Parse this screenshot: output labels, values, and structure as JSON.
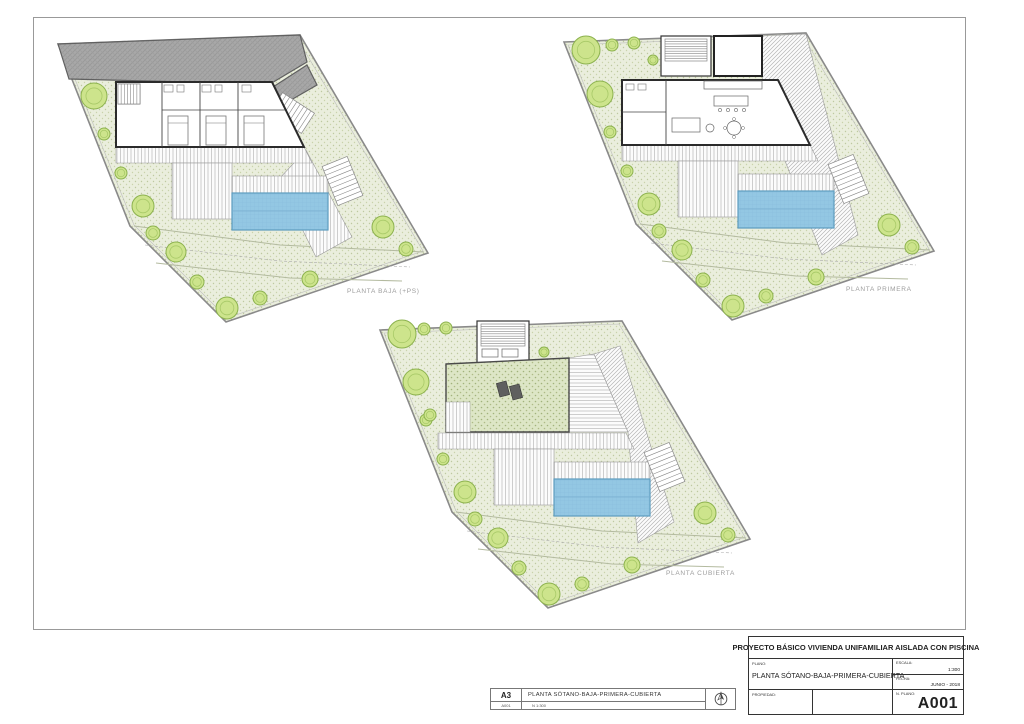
{
  "title_strip": {
    "sheet_size": "A3",
    "sheet_number": "A001",
    "title": "PLANTA SÓTANO-BAJA-PRIMERA-CUBIERTA",
    "scale_note": "N  1:300"
  },
  "title_block": {
    "project_title": "PROYECTO BÁSICO VIVIENDA UNIFAMILIAR AISLADA CON PISCINA",
    "plano_label": "PLANO:",
    "plano_value": "PLANTA SÓTANO-BAJA-PRIMERA-CUBIERTA",
    "escala_label": "ESCALA:",
    "escala_value": "1:300",
    "fecha_label": "FECHA:",
    "fecha_value": "JUNIO - 2018",
    "propiedad_label": "PROPIEDAD:",
    "nplano_label": "N. PLANO:",
    "nplano_value": "A001"
  },
  "colors": {
    "pool": "#93c7e3",
    "garden": "#eaeedd",
    "tree": "#cde48c",
    "street": "#a8a8a8",
    "label_gray": "#9c9c9c"
  },
  "geometry": {
    "base": [
      {
        "k": "poly",
        "pts": [
          [
            8,
            14
          ],
          [
            250,
            5
          ],
          [
            378,
            223
          ],
          [
            176,
            292
          ],
          [
            80,
            196
          ]
        ],
        "f": "pat:garden",
        "st": "#8a8a8a",
        "sw": 1.6
      },
      {
        "k": "poly",
        "pts": [
          [
            12,
            17
          ],
          [
            247,
            8
          ],
          [
            373,
            221
          ],
          [
            177,
            288
          ],
          [
            84,
            195
          ]
        ],
        "f": "none",
        "st": "#bcbcbc",
        "sw": 0.6
      },
      {
        "k": "pline",
        "pts": [
          [
            84,
            196
          ],
          [
            230,
            215
          ],
          [
            374,
            222
          ]
        ],
        "st": "#b3ba9f",
        "sw": 1
      },
      {
        "k": "pline",
        "pts": [
          [
            106,
            233
          ],
          [
            240,
            248
          ],
          [
            352,
            251
          ]
        ],
        "st": "#b3ba9f",
        "sw": 1
      },
      {
        "k": "pline",
        "pts": [
          [
            95,
            215
          ],
          [
            230,
            231
          ],
          [
            360,
            237
          ]
        ],
        "st": "#ababab",
        "sw": 0.6,
        "dash": true
      }
    ],
    "deck_common": [
      {
        "k": "poly",
        "pts": [
          [
            66,
            117
          ],
          [
            254,
            117
          ],
          [
            262,
            133
          ],
          [
            66,
            133
          ]
        ],
        "f": "pat:deckV",
        "st": "#9a9a9a",
        "sw": 0.6
      },
      {
        "k": "rect",
        "x": 122,
        "y": 133,
        "wd": 60,
        "ht": 56,
        "f": "pat:deckV",
        "st": "#9a9a9a",
        "sw": 0.6
      },
      {
        "k": "rect",
        "x": 182,
        "y": 146,
        "wd": 96,
        "ht": 17,
        "f": "pat:deckV",
        "st": "#9a9a9a",
        "sw": 0.6
      },
      {
        "k": "stairs",
        "x": 279,
        "y": 130,
        "wd": 27,
        "ht": 42,
        "n": 9,
        "rot": -22
      }
    ],
    "pool": [
      {
        "k": "rect",
        "x": 182,
        "y": 163,
        "wd": 96,
        "ht": 37,
        "f": "pat:pool",
        "st": "#5d9cbf",
        "sw": 1.2
      },
      {
        "k": "line",
        "x1": 182,
        "y1": 181,
        "x2": 278,
        "y2": 181,
        "st": "#7ab1d1",
        "sw": 0.8
      }
    ],
    "lower_trees": [
      [
        44,
        66,
        13
      ],
      [
        54,
        104,
        6
      ],
      [
        71,
        143,
        6
      ],
      [
        93,
        176,
        11
      ],
      [
        103,
        203,
        7
      ],
      [
        126,
        222,
        10
      ],
      [
        147,
        252,
        7
      ],
      [
        177,
        278,
        11
      ],
      [
        210,
        268,
        7
      ],
      [
        260,
        249,
        8
      ],
      [
        333,
        197,
        11
      ],
      [
        356,
        219,
        7
      ]
    ]
  },
  "plans": [
    {
      "id": "planta-baja",
      "label": "PLANTA BAJA (+PS)",
      "x": 50,
      "y": 30,
      "label_pos": [
        297,
        258
      ],
      "under": [
        {
          "k": "poly",
          "pts": [
            [
              8,
              14
            ],
            [
              250,
              5
            ],
            [
              257,
              32
            ],
            [
              220,
              54
            ],
            [
              19,
              49
            ]
          ],
          "f": "pat:street",
          "st": "#606060",
          "sw": 1.2
        },
        {
          "k": "poly",
          "pts": [
            [
              223,
              57
            ],
            [
              257,
              35
            ],
            [
              267,
              55
            ],
            [
              234,
              74
            ]
          ],
          "f": "pat:street",
          "st": "#606060",
          "sw": 1.2
        },
        {
          "k": "stairs",
          "x": 230,
          "y": 64,
          "wd": 24,
          "ht": 38,
          "n": 9,
          "rot": -57
        },
        {
          "k": "poly",
          "pts": [
            [
              256,
              120
            ],
            [
              302,
              207
            ],
            [
              266,
              227
            ],
            [
              228,
              150
            ]
          ],
          "f": "pat:deckV",
          "st": "#9a9a9a",
          "sw": 0.6
        }
      ],
      "over": [
        {
          "k": "poly",
          "pts": [
            [
              66,
              52
            ],
            [
              222,
              52
            ],
            [
              254,
              117
            ],
            [
              66,
              117
            ]
          ],
          "f": "#ffffff",
          "st": "#2b2b2b",
          "sw": 2
        },
        {
          "k": "line",
          "x1": 112,
          "y1": 52,
          "x2": 112,
          "y2": 117,
          "st": "#444444",
          "sw": 0.9
        },
        {
          "k": "line",
          "x1": 150,
          "y1": 52,
          "x2": 150,
          "y2": 117,
          "st": "#444444",
          "sw": 0.9
        },
        {
          "k": "line",
          "x1": 188,
          "y1": 52,
          "x2": 188,
          "y2": 117,
          "st": "#444444",
          "sw": 0.9
        },
        {
          "k": "line",
          "x1": 112,
          "y1": 80,
          "x2": 235,
          "y2": 80,
          "st": "#444444",
          "sw": 0.7
        },
        {
          "k": "rect",
          "x": 68,
          "y": 54,
          "wd": 22,
          "ht": 20,
          "f": "#ffffff",
          "st": "#555555",
          "sw": 0.8
        },
        {
          "k": "stairs",
          "x": 68,
          "y": 54,
          "wd": 22,
          "ht": 20,
          "n": 7,
          "rot": 0,
          "dir": "v"
        },
        {
          "k": "rect",
          "x": 118,
          "y": 86,
          "wd": 20,
          "ht": 29,
          "f": "#ffffff",
          "st": "#777777",
          "sw": 0.8
        },
        {
          "k": "line",
          "x1": 118,
          "y1": 93,
          "x2": 138,
          "y2": 93,
          "st": "#777777",
          "sw": 0.6
        },
        {
          "k": "rect",
          "x": 156,
          "y": 86,
          "wd": 20,
          "ht": 29,
          "f": "#ffffff",
          "st": "#777777",
          "sw": 0.8
        },
        {
          "k": "line",
          "x1": 156,
          "y1": 93,
          "x2": 176,
          "y2": 93,
          "st": "#777777",
          "sw": 0.6
        },
        {
          "k": "rect",
          "x": 194,
          "y": 86,
          "wd": 20,
          "ht": 29,
          "f": "#ffffff",
          "st": "#777777",
          "sw": 0.8
        },
        {
          "k": "line",
          "x1": 194,
          "y1": 93,
          "x2": 214,
          "y2": 93,
          "st": "#777777",
          "sw": 0.6
        },
        {
          "k": "rect",
          "x": 114,
          "y": 55,
          "wd": 9,
          "ht": 7,
          "f": "none",
          "st": "#777777",
          "sw": 0.6
        },
        {
          "k": "rect",
          "x": 127,
          "y": 55,
          "wd": 7,
          "ht": 7,
          "f": "none",
          "st": "#777777",
          "sw": 0.6
        },
        {
          "k": "rect",
          "x": 152,
          "y": 55,
          "wd": 9,
          "ht": 7,
          "f": "none",
          "st": "#777777",
          "sw": 0.6
        },
        {
          "k": "rect",
          "x": 165,
          "y": 55,
          "wd": 7,
          "ht": 7,
          "f": "none",
          "st": "#777777",
          "sw": 0.6
        },
        {
          "k": "rect",
          "x": 192,
          "y": 55,
          "wd": 9,
          "ht": 7,
          "f": "none",
          "st": "#777777",
          "sw": 0.6
        }
      ],
      "extra_trees": []
    },
    {
      "id": "planta-primera",
      "label": "PLANTA PRIMERA",
      "x": 556,
      "y": 28,
      "label_pos": [
        290,
        258
      ],
      "under": [
        {
          "k": "poly",
          "pts": [
            [
              206,
              8
            ],
            [
              250,
              6
            ],
            [
              302,
              207
            ],
            [
              266,
              227
            ],
            [
              224,
              120
            ],
            [
              206,
              48
            ]
          ],
          "f": "pat:deckD",
          "st": "#9a9a9a",
          "sw": 0.6
        }
      ],
      "over": [
        {
          "k": "rect",
          "x": 105,
          "y": 8,
          "wd": 50,
          "ht": 40,
          "f": "#ffffff",
          "st": "#333333",
          "sw": 1.2
        },
        {
          "k": "stairs",
          "x": 109,
          "y": 11,
          "wd": 42,
          "ht": 22,
          "n": 9,
          "rot": 0
        },
        {
          "k": "rect",
          "x": 158,
          "y": 8,
          "wd": 48,
          "ht": 40,
          "f": "#ffffff",
          "st": "#222222",
          "sw": 2
        },
        {
          "k": "poly",
          "pts": [
            [
              66,
              52
            ],
            [
              222,
              52
            ],
            [
              254,
              117
            ],
            [
              66,
              117
            ]
          ],
          "f": "#ffffff",
          "st": "#2b2b2b",
          "sw": 2
        },
        {
          "k": "line",
          "x1": 110,
          "y1": 52,
          "x2": 110,
          "y2": 117,
          "st": "#444444",
          "sw": 0.9
        },
        {
          "k": "line",
          "x1": 66,
          "y1": 84,
          "x2": 110,
          "y2": 84,
          "st": "#444444",
          "sw": 0.7
        },
        {
          "k": "rect",
          "x": 70,
          "y": 56,
          "wd": 8,
          "ht": 6,
          "f": "none",
          "st": "#777777",
          "sw": 0.6
        },
        {
          "k": "rect",
          "x": 82,
          "y": 56,
          "wd": 8,
          "ht": 6,
          "f": "none",
          "st": "#777777",
          "sw": 0.6
        },
        {
          "k": "rect",
          "x": 148,
          "y": 53,
          "wd": 58,
          "ht": 8,
          "f": "#ffffff",
          "st": "#666666",
          "sw": 0.7
        },
        {
          "k": "rect",
          "x": 158,
          "y": 68,
          "wd": 34,
          "ht": 10,
          "f": "#ffffff",
          "st": "#666666",
          "sw": 0.7
        },
        {
          "k": "circ",
          "cx": 164,
          "cy": 82,
          "r": 1.6,
          "f": "none",
          "st": "#666666",
          "sw": 0.6
        },
        {
          "k": "circ",
          "cx": 172,
          "cy": 82,
          "r": 1.6,
          "f": "none",
          "st": "#666666",
          "sw": 0.6
        },
        {
          "k": "circ",
          "cx": 180,
          "cy": 82,
          "r": 1.6,
          "f": "none",
          "st": "#666666",
          "sw": 0.6
        },
        {
          "k": "circ",
          "cx": 188,
          "cy": 82,
          "r": 1.6,
          "f": "none",
          "st": "#666666",
          "sw": 0.6
        },
        {
          "k": "rect",
          "x": 116,
          "y": 90,
          "wd": 28,
          "ht": 14,
          "f": "#ffffff",
          "st": "#666666",
          "sw": 0.7
        },
        {
          "k": "circ",
          "cx": 154,
          "cy": 100,
          "r": 4,
          "f": "none",
          "st": "#666666",
          "sw": 0.7
        },
        {
          "k": "circ",
          "cx": 178,
          "cy": 100,
          "r": 7,
          "f": "none",
          "st": "#666666",
          "sw": 0.7
        },
        {
          "k": "circ",
          "cx": 169,
          "cy": 100,
          "r": 1.5,
          "f": "none",
          "st": "#666666",
          "sw": 0.5
        },
        {
          "k": "circ",
          "cx": 187,
          "cy": 100,
          "r": 1.5,
          "f": "none",
          "st": "#666666",
          "sw": 0.5
        },
        {
          "k": "circ",
          "cx": 178,
          "cy": 91,
          "r": 1.5,
          "f": "none",
          "st": "#666666",
          "sw": 0.5
        },
        {
          "k": "circ",
          "cx": 178,
          "cy": 109,
          "r": 1.5,
          "f": "none",
          "st": "#666666",
          "sw": 0.5
        }
      ],
      "extra_trees": [
        [
          30,
          22,
          14
        ],
        [
          56,
          17,
          6
        ],
        [
          78,
          15,
          6
        ],
        [
          97,
          32,
          5
        ]
      ]
    },
    {
      "id": "planta-cubierta",
      "label": "PLANTA CUBIERTA",
      "x": 372,
      "y": 316,
      "label_pos": [
        294,
        254
      ],
      "under": [
        {
          "k": "poly",
          "pts": [
            [
              197,
              42
            ],
            [
              222,
              38
            ],
            [
              256,
              116
            ],
            [
              197,
              116
            ]
          ],
          "f": "pat:deckH",
          "st": "#9a9a9a",
          "sw": 0.6
        },
        {
          "k": "poly",
          "pts": [
            [
              222,
              38
            ],
            [
              248,
              30
            ],
            [
              302,
              206
            ],
            [
              266,
              227
            ],
            [
              256,
              116
            ]
          ],
          "f": "pat:deckD",
          "st": "#9a9a9a",
          "sw": 0.6
        }
      ],
      "over": [
        {
          "k": "rect",
          "x": 105,
          "y": 5,
          "wd": 52,
          "ht": 42,
          "f": "#ffffff",
          "st": "#333333",
          "sw": 1.2
        },
        {
          "k": "stairs",
          "x": 109,
          "y": 8,
          "wd": 44,
          "ht": 22,
          "n": 9,
          "rot": 0
        },
        {
          "k": "rect",
          "x": 110,
          "y": 33,
          "wd": 16,
          "ht": 8,
          "f": "none",
          "st": "#666666",
          "sw": 0.7
        },
        {
          "k": "rect",
          "x": 130,
          "y": 33,
          "wd": 16,
          "ht": 8,
          "f": "none",
          "st": "#666666",
          "sw": 0.7
        },
        {
          "k": "poly",
          "pts": [
            [
              74,
              48
            ],
            [
              197,
              42
            ],
            [
              197,
              116
            ],
            [
              74,
              116
            ]
          ],
          "f": "pat:gardenD",
          "st": "#4a4a4a",
          "sw": 1.4
        },
        {
          "k": "rect",
          "x": 74,
          "y": 86,
          "wd": 24,
          "ht": 30,
          "f": "pat:deckV",
          "st": "#9a9a9a",
          "sw": 0.5
        },
        {
          "k": "rect",
          "x": 126,
          "y": 66,
          "wd": 10,
          "ht": 14,
          "f": "#5f5f5f",
          "st": "#333333",
          "sw": 0.6,
          "rot": -15
        },
        {
          "k": "rect",
          "x": 139,
          "y": 69,
          "wd": 10,
          "ht": 14,
          "f": "#5f5f5f",
          "st": "#333333",
          "sw": 0.6,
          "rot": -15
        }
      ],
      "extra_trees": [
        [
          30,
          18,
          14
        ],
        [
          52,
          13,
          6
        ],
        [
          74,
          12,
          6
        ],
        [
          58,
          99,
          6
        ],
        [
          172,
          36,
          5
        ]
      ]
    }
  ]
}
